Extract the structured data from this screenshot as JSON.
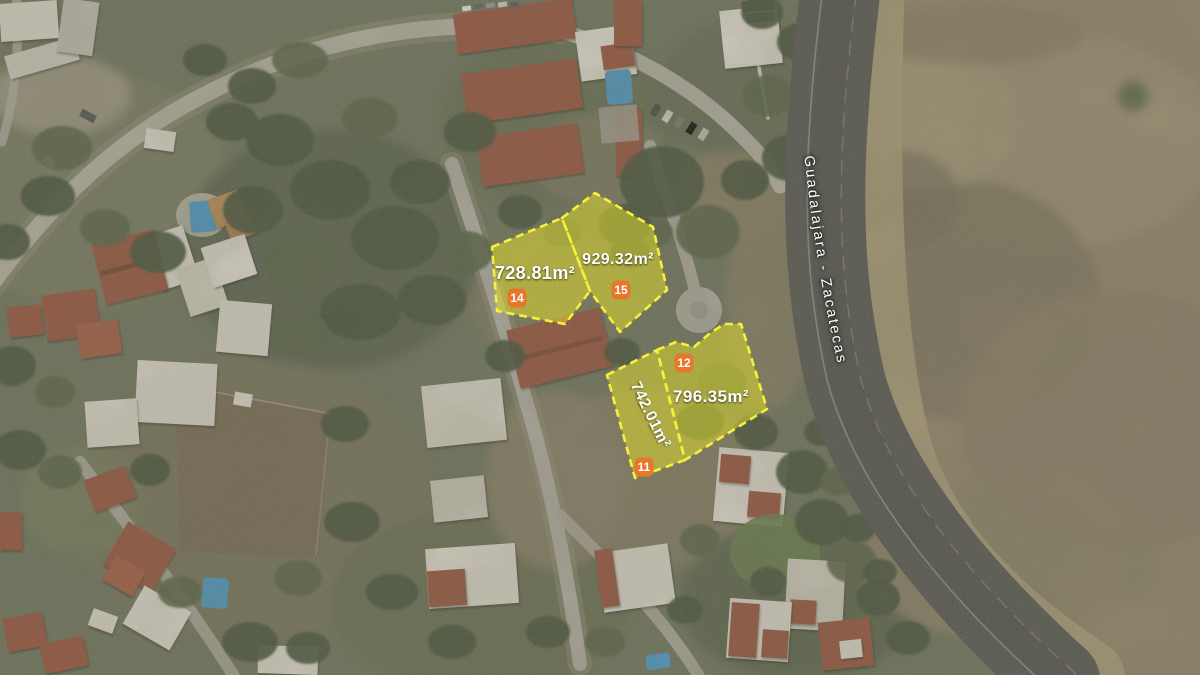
{
  "map": {
    "road_label": "Guadalajara - Zacatecas",
    "lots": [
      {
        "number": "14",
        "area": "728.81m²"
      },
      {
        "number": "15",
        "area": "929.32m²"
      },
      {
        "number": "11",
        "area": "742.01m²"
      },
      {
        "number": "12",
        "area": "796.35m²"
      }
    ],
    "colors": {
      "parcel_fill": "#e0dd2e",
      "parcel_stroke": "#f4f13a",
      "badge_fill": "#e8772c",
      "label_text": "#ffffff",
      "highway_asphalt": "#4b4b47",
      "field_tan": "#8a7d61",
      "neighborhood_green": "#646a52"
    }
  }
}
